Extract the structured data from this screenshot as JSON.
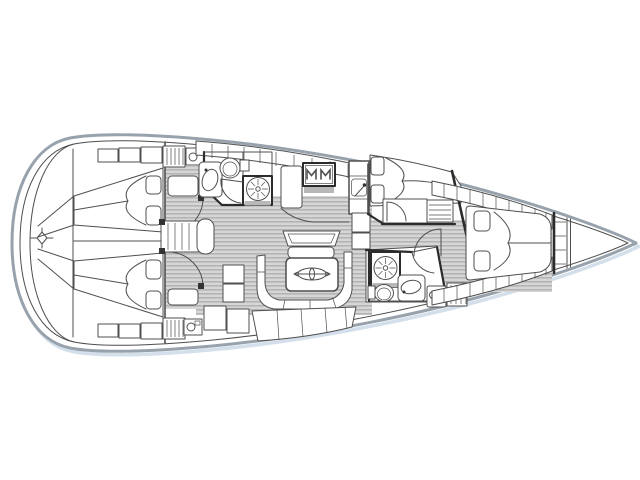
{
  "diagram": {
    "label": "Sailing yacht interior layout floor plan, top view, bow to the right",
    "type": "floor-plan"
  },
  "colors": {
    "background": "#ffffff",
    "hull-outline": "#98a2ac",
    "hull-shadow": "#d3dfea",
    "line": "#4f4f4f",
    "wall": "#2b2b2b",
    "floor-base": "#d6d6d6",
    "floor-stripe": "#a6a6a6",
    "fixture": "#b8b8b8",
    "accent-dark": "#333333"
  },
  "features": [
    "stern-swim-platform",
    "aft-cabin-port-double-berth",
    "aft-cabin-starboard-double-berth",
    "aft-cabin-wardrobes",
    "companionway-steps",
    "aft-head-with-sink-toilet-shower",
    "saloon-u-settee",
    "saloon-table-with-compass-emblem",
    "saloon-bench-seat",
    "galley-with-stove-and-sink",
    "pullman-berth-cabin",
    "forward-head-with-shower-and-toilet",
    "vanity-chart-unit",
    "owners-v-berth-cabin",
    "hull-side-shelves",
    "bow-anchor-locker"
  ]
}
